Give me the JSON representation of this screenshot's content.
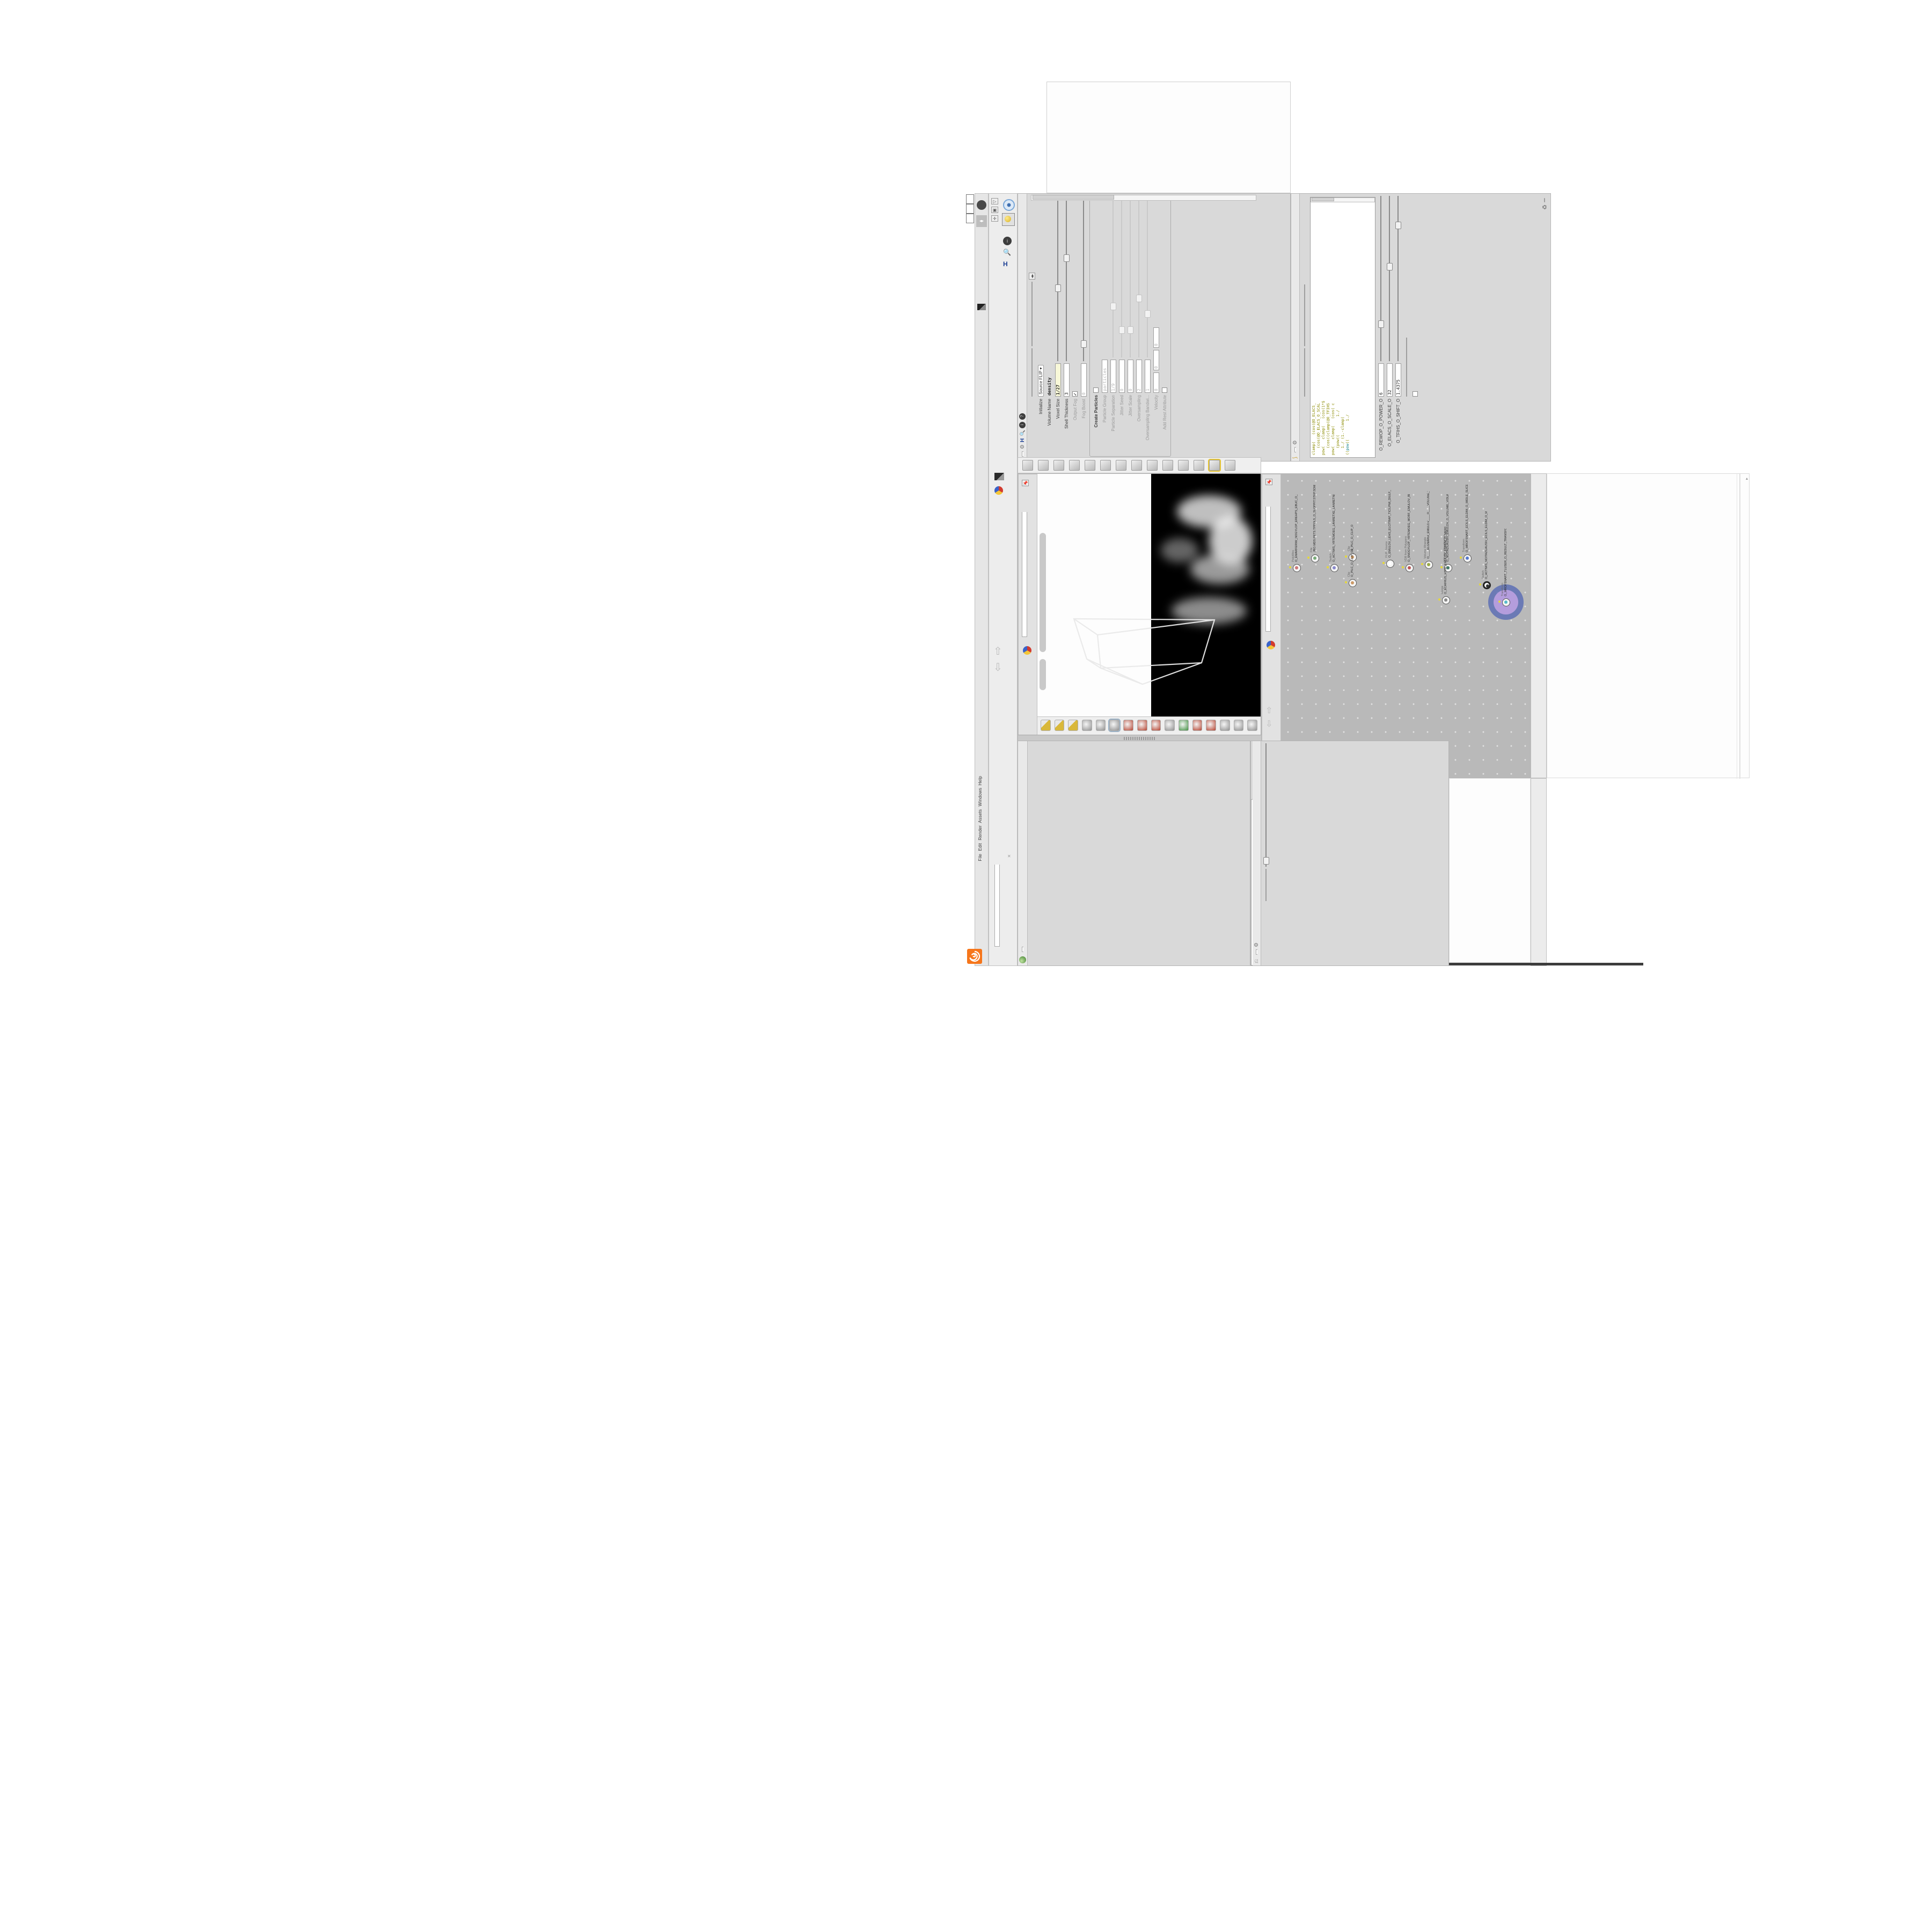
{
  "app_colors": {
    "accent_orange": "#f6761b",
    "selection_purple": "#b49ddc",
    "selection_ring_blue": "#5d6fb4",
    "wire_blue": "#6b80b8",
    "network_gray": "#b9b9b9",
    "value_yellow": "#f8f8d8",
    "code_olive": "#8b8b00",
    "delete_red": "#d84343",
    "input_blue": "#4f93d6"
  },
  "window": {
    "controls": [
      "×",
      "❐",
      "–"
    ],
    "title_strip": "_O____#VDB#_#GLOW#____#17_5#____O.HIP (Thu Feb  4 10:46:01 2021)",
    "status_message": "2 Successfully saved PIH.O____#5_71#____#WOLG#_#BDV#____",
    "titlebar_path": "C:/O/O_AIDIV_O_VIDIA_O/O_INIDUOH_O",
    "desktop_menu": "Main",
    "menu_items": [
      "File",
      "Edit",
      "Render",
      "Assets",
      "Windows",
      "Help"
    ],
    "help_badge": "?"
  },
  "tabs": {
    "pane_tab_italic": "O_FLUID_IMPLICIT_PARTI...",
    "geometry_tab": "O_YRTEMOEG_O_GEOMETRY_O",
    "mantra_tab": "O___ARTNAM___O...",
    "visualization_tab": "O_NOITAZILAUSIV...",
    "context_path": "obj"
  },
  "flip_source": {
    "title": "FLIP Source",
    "node_tab": "O_EMULOV_LEHS_ELCITRAP_TICI",
    "asset_label": "Asset Name and Path",
    "asset_name": "flipsource",
    "asset_path": "C:/O/O_ERAWTF...",
    "rows": [
      {
        "label": "Initialize",
        "kind": "drop",
        "value": "Source FLIP"
      },
      {
        "label": "Volume Name",
        "kind": "bold",
        "value": "density"
      },
      {
        "label": "Voxel Size",
        "kind": "yellow",
        "value": "1/27",
        "slider": 0.42
      },
      {
        "label": "Shell Thickness",
        "kind": "field",
        "value": "3",
        "slider": 0.6
      },
      {
        "label": "Output Fog",
        "kind": "check",
        "value": "",
        "checked": true
      },
      {
        "label": "Fog Boost",
        "kind": "dimfield",
        "value": "0",
        "slider": 0.08
      }
    ],
    "particles_group": {
      "group_label": "Particles",
      "rows": [
        {
          "label": "Create Particles",
          "kind": "checkbold",
          "value": ""
        },
        {
          "label": "Particle Group",
          "kind": "dimfield",
          "value": "particles"
        },
        {
          "label": "Particle Separation",
          "kind": "dimfield",
          "value": "1/9",
          "slider": 0.3
        },
        {
          "label": "Jitter Seed",
          "kind": "dimfield",
          "value": "0",
          "slider": 0.15
        },
        {
          "label": "Jitter Scale",
          "kind": "dimfield",
          "value": "0",
          "slider": 0.15
        },
        {
          "label": "Oversampling",
          "kind": "dimfield",
          "value": "2",
          "slider": 0.35
        },
        {
          "label": "Oversampling Bandwi...",
          "kind": "dimfield",
          "value": "1",
          "slider": 0.25
        },
        {
          "label": "Velocity",
          "kind": "dim3",
          "value": "0",
          "value2": "0",
          "value3": "0"
        },
        {
          "label": "Add Rest Attribute",
          "kind": "check",
          "value": ""
        }
      ]
    }
  },
  "volume_wrangle": {
    "title": "Volume Wrangle",
    "node_tab": "O____ELGNARW_EMULOV____O",
    "tab_long": "O____ELGNARW_EMULOV____O____VOLUME_WRANGL...",
    "asset_label": "Asset Name and Path",
    "asset_name": "volumewrangle",
    "asset_path": "C:/O/O_ERAWTF...",
    "code_lines": [
      "clamp(   (cos(@O_ELACS_",
      "   (cos(@O_ELACS_O_SCAL",
      "pow(   clamp(   (cos(1*$",
      "   (cos((clamp(@O_TFIHS",
      "pow(   clamp(   (cos( c",
      "   (pow((        1./",
      "   1./ (1.-clamp(",
      "((pow((        1./"
    ],
    "cursor_pos": "Ln 1, Col 1",
    "spare_rows": [
      {
        "label": "O_REWOP_O_POWER_O",
        "value": "6",
        "slider": 0.2
      },
      {
        "label": "O_ELACS_O_SCALE_O",
        "value": "32",
        "slider": 0.55
      },
      {
        "label": "O_TFIHS_O_SHIFT_O",
        "value": "1.4375",
        "slider": 0.8
      }
    ],
    "volumes_label": "Volumes to Write-to",
    "volumes_value": "density",
    "enforce_label": "Enforce Prototypes",
    "auto_update": "Auto Update"
  },
  "viewport": {
    "camera_pill": "O____AREMAC____O____CAMERA____O",
    "projection_pill": "Ortho",
    "tab": "O_YRTEMOEG_O_GEOMETRY_O",
    "context": "obj"
  },
  "network": {
    "watermark": "Geometr",
    "title_strip": "_O____#VDB#_#GLOW#____#17_5#____O.HIP (Thu Feb  4 10:46:01 2021)",
    "nodes": [
      {
        "type": "PolyWire",
        "name": "O_EMARFERIW_NOGYLOP_EREHPS_EBUC_O_CUBE_SPHERE_POLYGON_WIREFRAME_O",
        "glyph": "#c77"
      },
      {
        "type": "File",
        "name": "JBO.MDS.PETS.TPPOLS_O_SLOPPIT.STEP.SDM.OBJ",
        "glyph": "#7a7"
      },
      {
        "type": "Switch",
        "name": "O_HCTIWS_YRTEMOEG_LANRETXE_LANRETNI_O_INTERNAL_EXTERNAL_GEOMETRY_SWITCH_O",
        "glyph": "#88c"
      },
      {
        "type": "Clip",
        "name": "O_PILC_O_CLIP_O",
        "glyph": "#c96"
      },
      {
        "type": "Clip",
        "name": "O_PILC_O_CLIP_O2",
        "glyph": "#c96"
      },
      {
        "type": "FLIP Source",
        "name": "O_EMULOV_LEHS_ELCITRAP_TICILPMI_DIULF_O_FLUID_IMPLICIT_PARTICLE_SHEL_VOLUME_O",
        "glyph": "#fff"
      },
      {
        "type": "VDB from Polygons",
        "name": "O_SNOGYLOP_YRTEMOEG_MORF_EMULOV_BDV_O_VDB_VOLUME_FROM_GEOMETRY_O",
        "glyph": "#b55"
      },
      {
        "type": "Volume Wrangle",
        "name": "O____ELGNARW_EMULOV____O____VOLUME_WRANGLE____O2",
        "glyph": "#9a4"
      },
      {
        "type": "Volume Visualization",
        "name": "O_NOITAZILAUSIV_EMULOV_O_VOLUME_VISUALIZATION_O",
        "glyph": "#476"
      },
      {
        "type": "Transform",
        "name": "O_MROFSNART_ECILS_ELDIM_O_MIDLE_SLICE_TRANSFORM_O",
        "glyph": "#57c"
      },
      {
        "type": "Switch",
        "name": "O_HCTIWS_NOITAZILAUSIV_ECILS_ELDIM_O_MIDLE_SLICE_VISUALIZATION_SWITCH_O",
        "glyph": "#333",
        "ring": true
      },
      {
        "type": "Merge",
        "name": "O_ECAFRUS_HTIW_EMULOV_EGREM_O_MERGE_VOLUME_WITH_SURFACE_O",
        "glyph": "#888"
      },
      {
        "type": "Transform",
        "name": "O_MROFSNART_TLUSER_O_RESULT_TRANSFORM_O",
        "glyph": "#5bc",
        "selected": true
      }
    ]
  },
  "volume_visualization": {
    "title": "Volume Visualization",
    "node_tab": "O_NOITAZILAUSIV_EMULO",
    "density_field_label": "Density Field",
    "density_field_value": "density",
    "density_section": "Density",
    "mode_label": "Mode",
    "mode_value": "Clamped...",
    "density_ramp_label": "Density Ramp",
    "diffuse_field_label": "Diffuse Field",
    "diffuse_field_value": "density",
    "diffuse_range_label": "Diffuse Range",
    "diffuse_range_min": "0",
    "diffuse_range_max": "1",
    "diffuse_section": "Diffuse",
    "mode2_value": "Clamped R...",
    "diffuse_ramp_label": "Diffuse Ramp",
    "presets": "Presets",
    "point_no_label": "Point No.",
    "point_no_value": "1",
    "position_label": "Position",
    "position_value": "0",
    "color_label": "Color",
    "h_label": "H",
    "h_value": "0",
    "s_label": "S",
    "s_value": "0",
    "v_label": "V",
    "v_value": "1.8125",
    "interpolation_label": "Interpolation",
    "interpolation_value": "Linear"
  },
  "switch_node": {
    "title": "Switch",
    "node_tab": "O_HCTIWS_NOITAZILAUSIV_ECILS_EL",
    "pane_tab": "O_HCTIWS_NOITAZILAUSIV_ECILS_ELDIM_O_MIDLE_SLICE_VISU...",
    "select_input_label": "Select Input",
    "select_input_value": "0",
    "list_label": "Input Operators (Drag/Drop to reorder)",
    "inputs": [
      "O_NOITAZILAUSIV_EMULOV_O_VOLUME_VISUALIZATION...",
      "O_MROFSNART_ECILS_ELDIM_O_MIDLE_SLICE_TRANSFO..."
    ]
  },
  "shelf": {
    "tools": [
      "comet",
      "spray",
      "fan",
      "cloth",
      "curve-falloff",
      "box-points",
      "tripod",
      "torus",
      "glue",
      "panel-split",
      "camera-pan",
      "dot",
      "grid-highlight",
      "film-roll"
    ]
  },
  "viewport_toolbar": {
    "buttons": [
      "shade-flat",
      "shade-smooth",
      "shade-wire",
      "back",
      "select-arrow",
      "c4-display",
      "move-handles",
      "rotate-handles",
      "scale-handles",
      "cut-dim",
      "axis-color",
      "snap-grid",
      "snap-magnet",
      "forward",
      "brushes",
      "film"
    ]
  }
}
